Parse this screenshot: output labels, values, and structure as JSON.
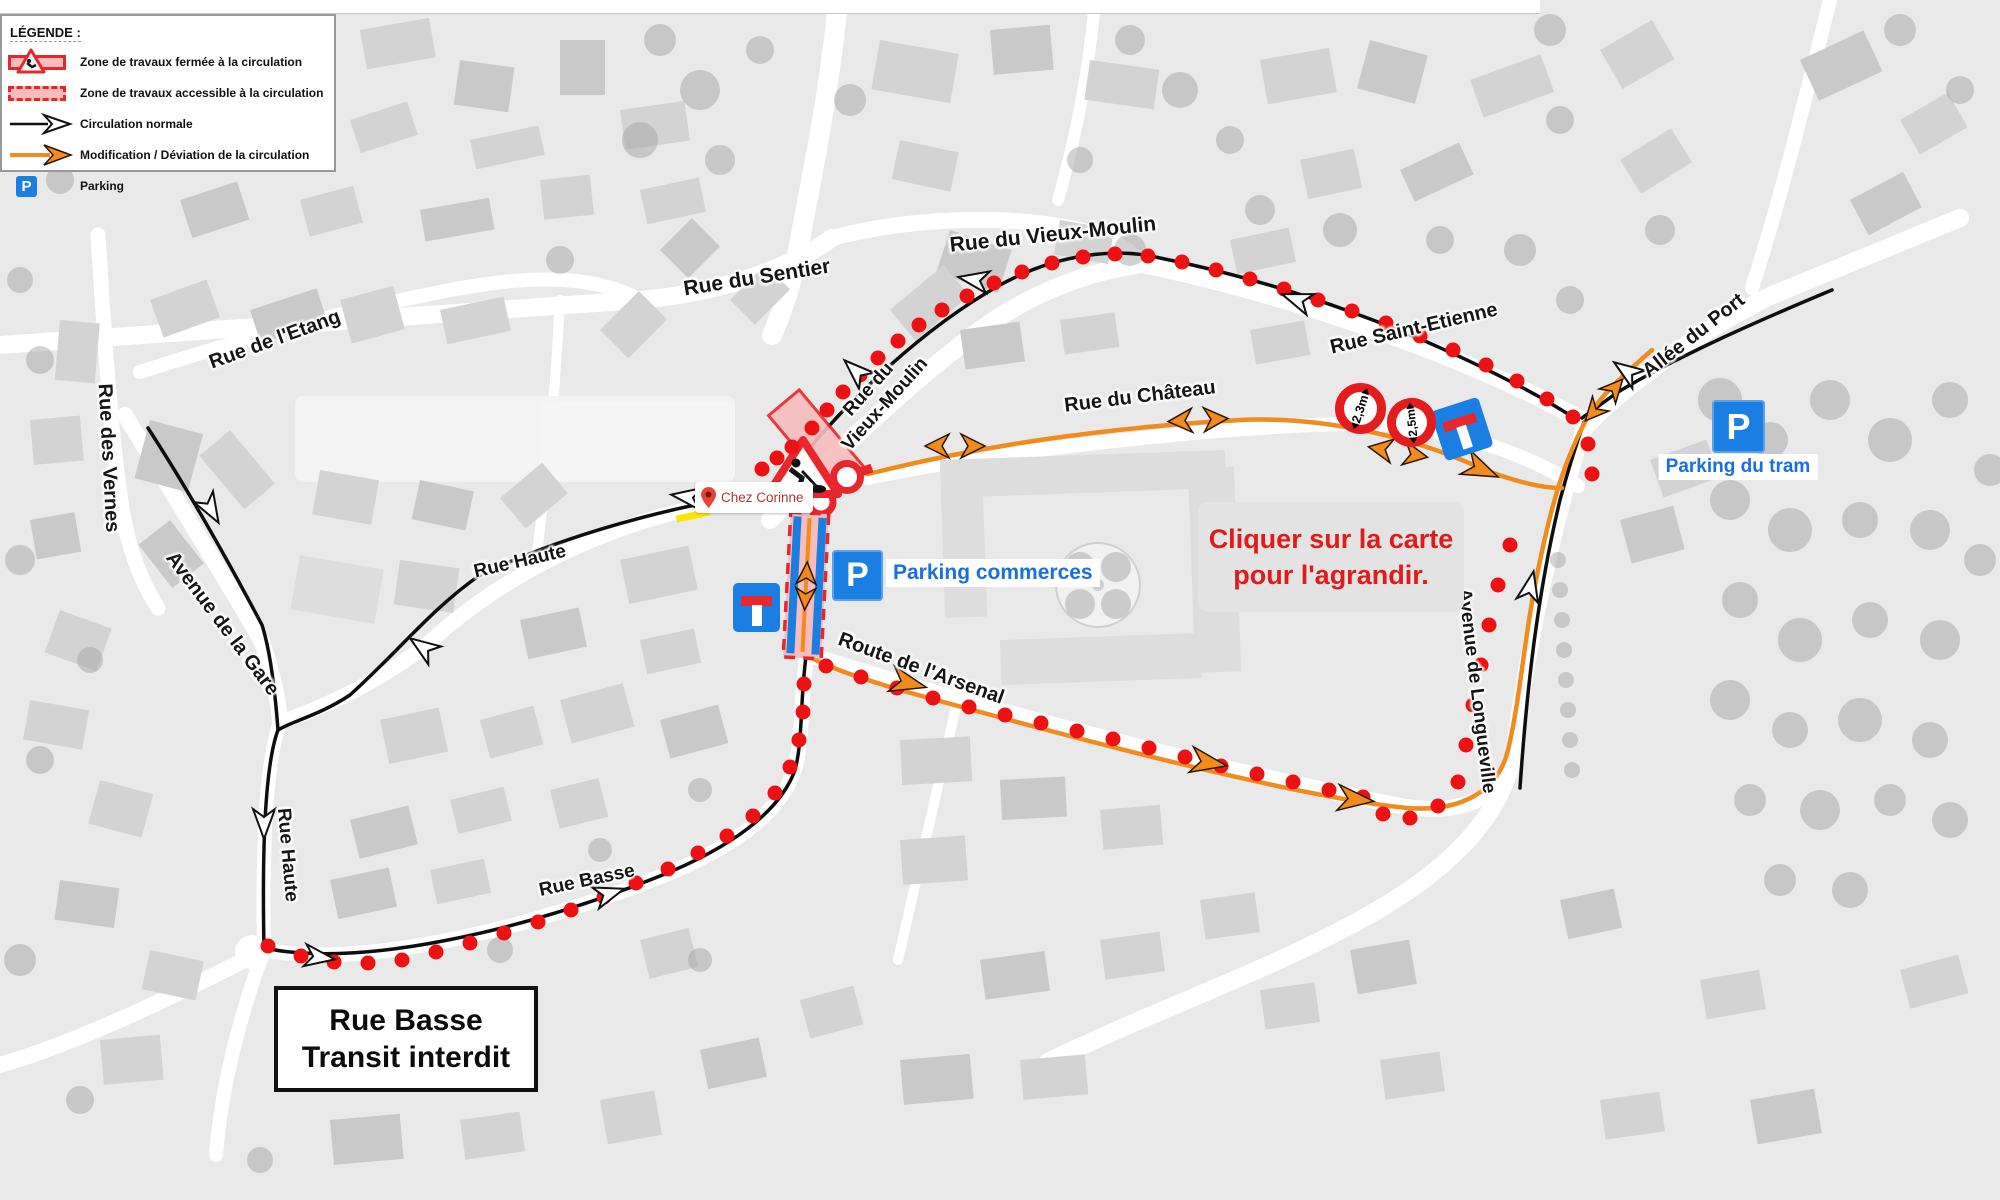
{
  "legend": {
    "title": "LÉGENDE :",
    "items": [
      {
        "icon": "closed-work-zone-icon",
        "label": "Zone de travaux fermée à la circulation"
      },
      {
        "icon": "accessible-work-zone-icon",
        "label": "Zone de travaux accessible à la circulation"
      },
      {
        "icon": "normal-traffic-arrow-icon",
        "label": "Circulation normale"
      },
      {
        "icon": "deviation-arrow-icon",
        "label": "Modification / Déviation de la circulation"
      },
      {
        "icon": "parking-icon",
        "label": "Parking"
      }
    ]
  },
  "streets": {
    "sentier": "Rue du Sentier",
    "vieux_moulin_top": "Rue du Vieux-Moulin",
    "vieux_moulin_l1": "Rue du",
    "vieux_moulin_l2": "Vieux-Moulin",
    "saint_etienne": "Rue Saint-Etienne",
    "allee_du_port": "Allée du Port",
    "etang": "Rue de l'Etang",
    "vernes": "Rue des Vernes",
    "gare": "Avenue de la Gare",
    "haute_upper": "Rue Haute",
    "haute_lower": "Rue Haute",
    "basse": "Rue Basse",
    "chateau": "Rue du Château",
    "arsenal": "Route de l'Arsenal",
    "longueville": "Avenue de Longueville"
  },
  "poi": {
    "chez_corinne": "Chez Corinne",
    "parking_commerces": "Parking commerces",
    "parking_du_tram": "Parking du tram",
    "parking_letter": "P"
  },
  "notes": {
    "click_line1": "Cliquer sur la carte",
    "click_line2": "pour l'agrandir.",
    "transit_line1": "Rue Basse",
    "transit_line2": "Transit interdit"
  },
  "signs": {
    "limit_1": "2,3m",
    "limit_2": "2,5m"
  },
  "colors": {
    "deviation_orange": "#f28b1d",
    "works_red": "#e8262b",
    "dot_red": "#ee1111",
    "parking_blue": "#1a7ee3",
    "zone_pink": "#f7bcbc"
  }
}
